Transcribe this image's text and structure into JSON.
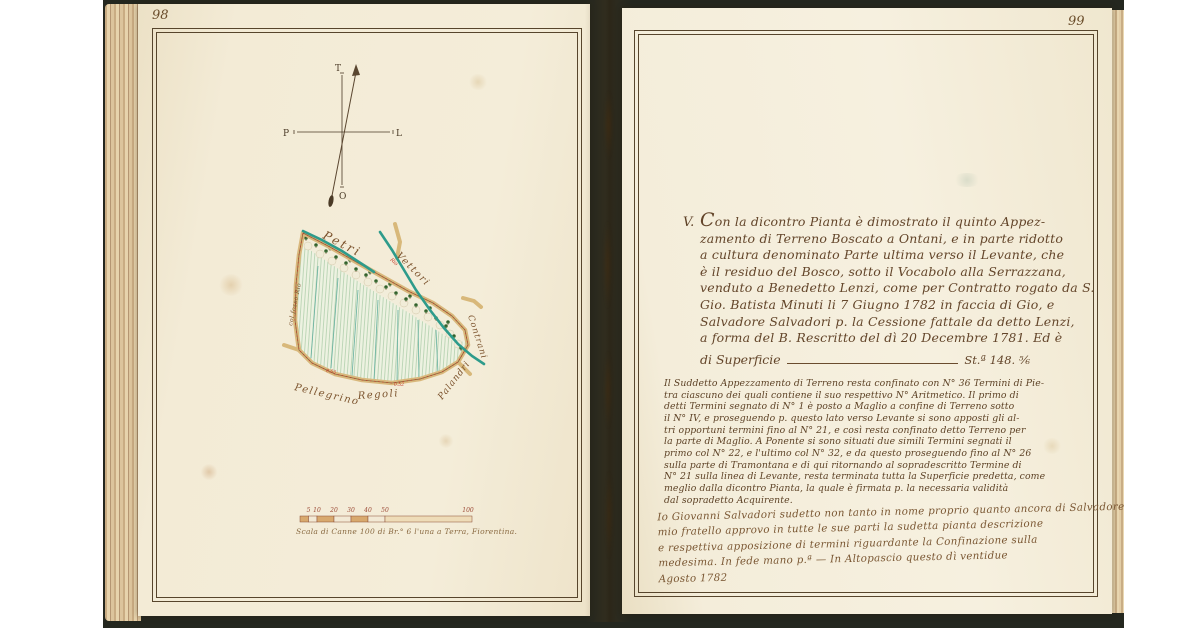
{
  "left_page": {
    "page_number": "98",
    "compass": {
      "north": "T",
      "east": "L",
      "south": "O",
      "west": "P"
    },
    "map": {
      "labels": {
        "petri": "Petri",
        "vettori": "Vettori",
        "contrani": "Contrani",
        "palandri": "Palandri",
        "pellegrino": "Pellegrino",
        "regoli": "Regoli",
        "fosso": "col fosso Rio",
        "stream": "Rio",
        "measure_a": "0.55",
        "measure_b": "0.52"
      }
    },
    "scale": {
      "ticks": [
        "5",
        "10",
        "20",
        "30",
        "40",
        "50",
        "100"
      ],
      "caption": "Scala di Canne 100 di Br.° 6 l'una a Terra, Fiorentina."
    }
  },
  "right_page": {
    "page_number": "99",
    "section_marker": "V.",
    "deed": {
      "lines": [
        "Con la dicontro Pianta è dimostrato il quinto Appez-",
        "zamento di Terreno Boscato a Ontani, e in parte ridotto",
        "a cultura denominato Parte ultima verso il Levante, che",
        "è il residuo del Bosco, sotto il Vocabolo alla Serrazzana,",
        "venduto a Benedetto Lenzi, come per Contratto rogato da S.",
        "Gio. Batista Minuti li 7 Giugno 1782 in faccia di Gio, e",
        "Salvadore Salvadori p. la Cessione fattale da detto Lenzi,",
        "a forma del B. Rescritto del dì 20 Decembre 1781. Ed è"
      ]
    },
    "area_line": {
      "label": "di Superficie",
      "value": "St.ª 148. ⅚"
    },
    "boundary_note": {
      "lines": [
        "Il Suddetto Appezzamento di Terreno resta confinato con N° 36 Termini di Pie-",
        "tra ciascuno dei quali contiene il suo respettivo N° Aritmetico. Il primo di",
        "detti Termini segnato di N° 1 è posto a Maglio a confine di Terreno sotto",
        "il N° IV, e proseguendo p. questo lato verso Levante si sono apposti gli al-",
        "tri opportuni termini fino al N° 21, e così resta confinato detto Terreno per",
        "la parte di Maglio. A Ponente si sono situati due simili Termini segnati il",
        "primo col N° 22, e l'ultimo col N° 32, e da questo proseguendo fino al N° 26",
        "sulla parte di Tramontana e di qui ritornando al sopradescritto Termine di",
        "N° 21 sulla linea di Levante, resta terminata tutta la Superficie predetta, come",
        "meglio dalla dicontro Pianta, la quale è firmata p. la necessaria validità",
        "dal sopradetto Acquirente."
      ]
    },
    "approval_note": {
      "lines": [
        "Io Giovanni Salvadori sudetto non tanto in nome proprio quanto ancora di Salvadore",
        "mio fratello approvo in tutte le sue parti la sudetta pianta descrizione",
        "e respettiva apposizione di termini riguardante la Confinazione sulla",
        "medesima. In fede mano p.ª — In Altopascio questo dì ventidue",
        "Agosto 1782"
      ]
    }
  },
  "colors": {
    "ink": "#63452a",
    "survey_red": "#c23b2a",
    "stream_teal": "#2e9b8b",
    "road_tan": "#d9b87c",
    "field_green": "#a9cba6",
    "page_cream": "#f3ebd6"
  }
}
